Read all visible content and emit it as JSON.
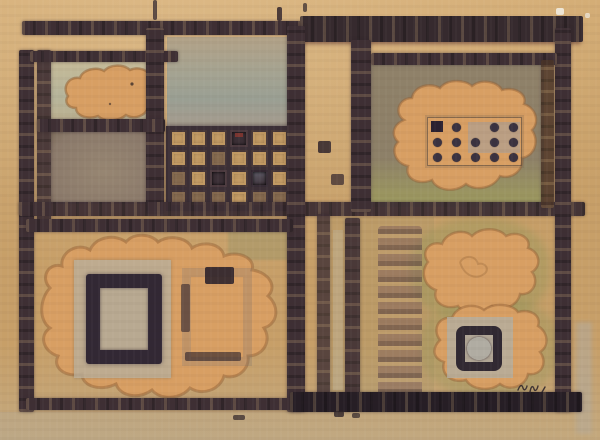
{
  "artwork": {
    "kind": "abstract mixed-media painting photograph",
    "visible_text": "none (illegible painted signature mark lower right)"
  },
  "palette": {
    "canvas": "#c79f68",
    "canvas_light": "#d4ad76",
    "margin_bottom": "#c3a87e",
    "dark": "#3e2f34",
    "dark_deep": "#261e25",
    "maroon": "#5e3531",
    "orange": "#d89f63",
    "orange_deep": "#cf9357",
    "orange_edge": "#a8743f",
    "cell_green": "#bcb290",
    "cell_blue_grey": "#9fa295",
    "cell_taupe": "#8b7a6b",
    "olive_cell": "#8d8068",
    "olive_green": "#9b9660",
    "grey_square": "#b7ab93",
    "stamp_dark": "#2a2130",
    "mauve": "#6f4e55",
    "dot_dark": "#3a3240",
    "blue_wash": "#93a0b0",
    "waffle_dark": "#3b2f36",
    "waffle_tan": "#c39b63"
  },
  "waffle_grid": {
    "rows": 4,
    "cols": 6,
    "pattern": [
      [
        "tan",
        "tan",
        "tan",
        "dark-red",
        "tan",
        "tan"
      ],
      [
        "tan",
        "tan",
        "dim",
        "tan",
        "tan",
        "tan"
      ],
      [
        "dim",
        "tan",
        "dark",
        "tan",
        "blue",
        "tan"
      ],
      [
        "dim",
        "dim",
        "dim",
        "tan",
        "dim",
        "dim"
      ]
    ]
  },
  "dot_grid": {
    "rows": 3,
    "cols": 5,
    "cells": [
      [
        "square",
        "dot",
        "blank",
        "dot",
        "dot"
      ],
      [
        "dot",
        "dot",
        "dot",
        "dot",
        "dot"
      ],
      [
        "dot",
        "dot",
        "dot",
        "dot",
        "dot"
      ]
    ]
  }
}
